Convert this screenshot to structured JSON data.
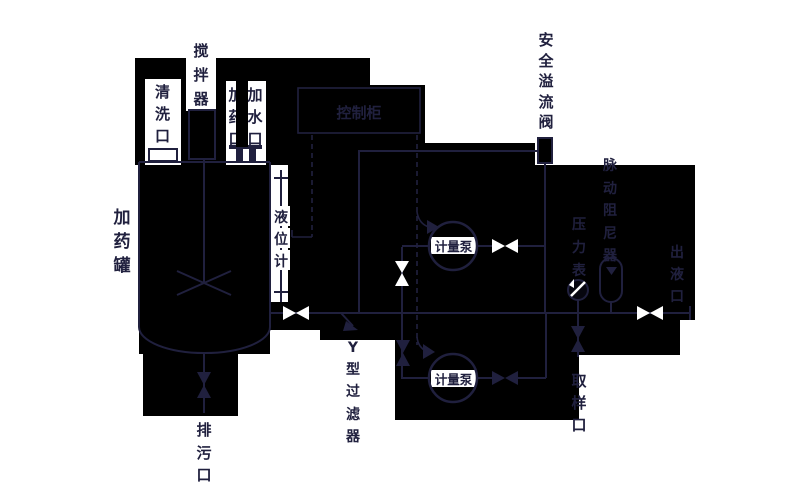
{
  "diagram": {
    "type": "piping-and-instrumentation-schematic",
    "system": "chemical dosing skid",
    "labels": {
      "tank": "加药罐",
      "agitator": "搅拌器",
      "cleaning_port": "清洗口",
      "dosing_port": "加药口",
      "water_port": "加水口",
      "control_cabinet": "控制柜",
      "level_gauge": "液位计",
      "drain_port": "排污口",
      "y_strainer": "Y型过滤器",
      "safety_relief_valve": "安全溢流阀",
      "pulsation_damper": "脉动阻尼器",
      "pressure_gauge": "压力表",
      "outlet_port": "出液口",
      "sampling_port": "取样口",
      "metering_pump_1": "计量泵",
      "metering_pump_2": "计量泵"
    },
    "colors": {
      "page_background": "#ffffff",
      "panel_background": "#000000",
      "line_and_text": "#20203e",
      "open_symbol": "#ffffff"
    }
  }
}
